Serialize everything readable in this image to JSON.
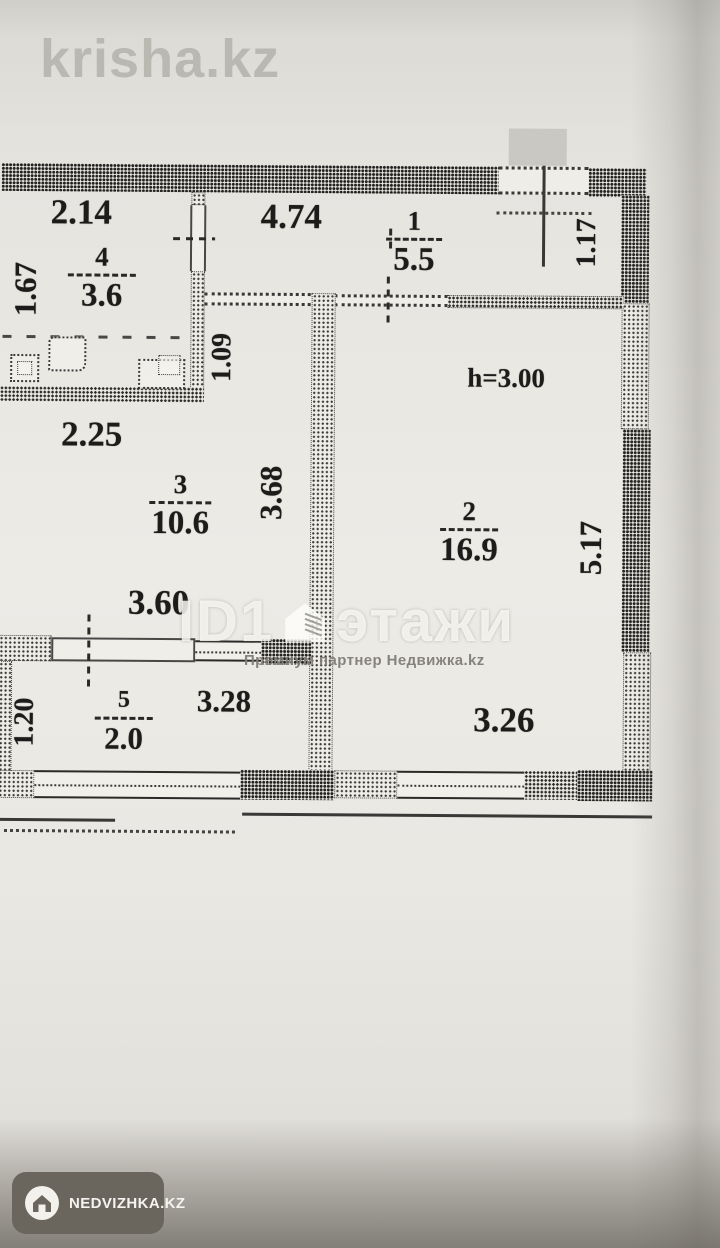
{
  "watermarks": {
    "krisha": "krisha.kz",
    "etazhi_prefix": "ID1",
    "etazhi_name": "этажи",
    "etazhi_subtitle": "Премиум партнер Недвижка.kz",
    "badge_label": "NEDVIZHKA.KZ"
  },
  "plan": {
    "ceiling_height_label": "h=3.00",
    "rooms": [
      {
        "number": "1",
        "area": "5.5"
      },
      {
        "number": "2",
        "area": "16.9"
      },
      {
        "number": "3",
        "area": "10.6"
      },
      {
        "number": "4",
        "area": "3.6"
      },
      {
        "number": "5",
        "area": "2.0"
      }
    ],
    "dimensions": {
      "kitchen_width": "2.14",
      "hall_width": "4.74",
      "entry_depth": "1.17",
      "kitchen_depth": "1.67",
      "recess_depth": "1.09",
      "room3_upper_width": "2.25",
      "room3_depth": "3.68",
      "room2_depth": "5.17",
      "room3_width": "3.60",
      "balcony_depth": "1.20",
      "balcony_width": "3.28",
      "room2_width": "3.26"
    },
    "colors": {
      "paper": "#eceae5",
      "ink": "#1d1c1a",
      "watermark_gray": "#b9b8b1",
      "badge_bg": "#6b665d"
    }
  }
}
